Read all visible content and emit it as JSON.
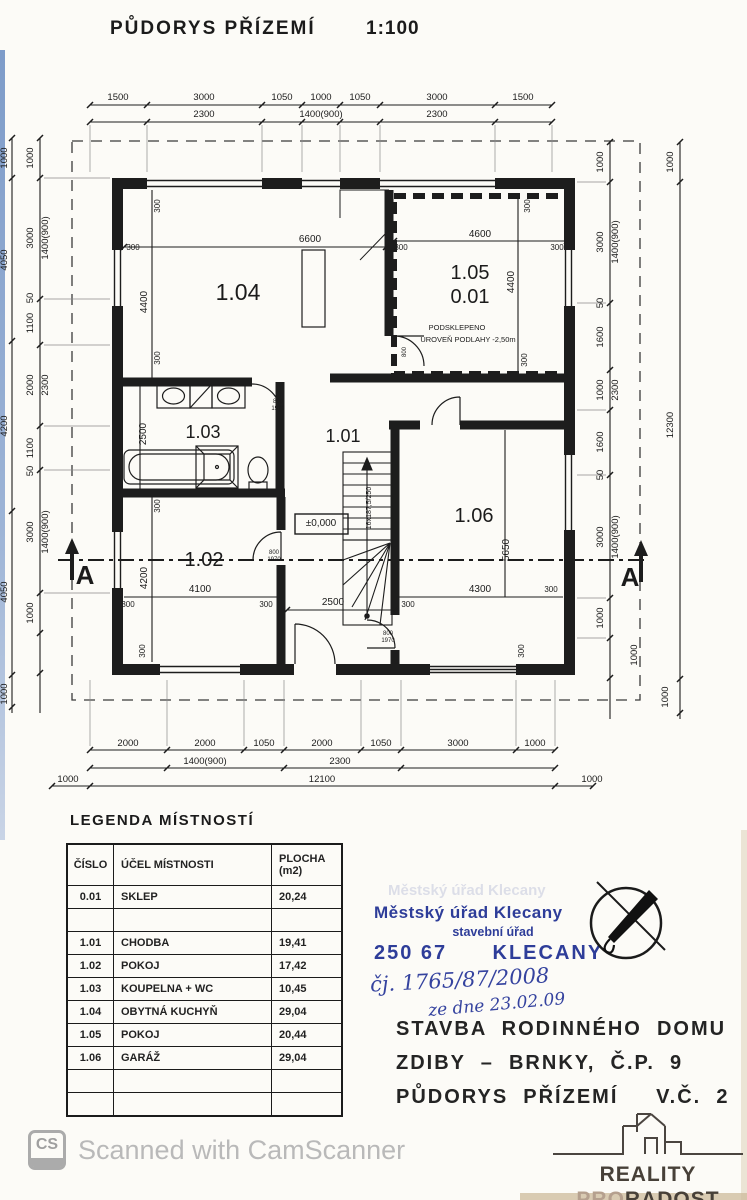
{
  "page": {
    "title": "PŮDORYS PŘÍZEMÍ",
    "scale": "1:100"
  },
  "colors": {
    "ink": "#1b1b1b",
    "stamp_blue": "#2e3d99",
    "handwriting_blue": "#35439f",
    "watermark_gray": "#b9b9b9",
    "logo_dark": "#474038",
    "logo_tan": "#b5a08e"
  },
  "legend": {
    "heading": "LEGENDA MÍSTNOSTÍ",
    "columns": {
      "no": "ČÍSLO",
      "name": "ÚČEL MÍSTNOSTI",
      "area1": "PLOCHA",
      "area2": "(m2)"
    },
    "rows": [
      {
        "no": "0.01",
        "name": "SKLEP",
        "area": "20,24"
      },
      {
        "no": "",
        "name": "",
        "area": ""
      },
      {
        "no": "1.01",
        "name": "CHODBA",
        "area": "19,41"
      },
      {
        "no": "1.02",
        "name": "POKOJ",
        "area": "17,42"
      },
      {
        "no": "1.03",
        "name": "KOUPELNA + WC",
        "area": "10,45"
      },
      {
        "no": "1.04",
        "name": "OBYTNÁ KUCHYŇ",
        "area": "29,04"
      },
      {
        "no": "1.05",
        "name": "POKOJ",
        "area": "20,44"
      },
      {
        "no": "1.06",
        "name": "GARÁŽ",
        "area": "29,04"
      },
      {
        "no": "",
        "name": "",
        "area": ""
      },
      {
        "no": "",
        "name": "",
        "area": ""
      }
    ]
  },
  "stamp": {
    "line1": "Městský úřad Klecany",
    "line2": "stavební úřad",
    "line3": "250 67      KLECANY",
    "handwriting1": "čj. 1765/87/2008",
    "handwriting2": "ze dne 23.02.09"
  },
  "project": {
    "line1": "STAVBA  RODINNÉHO  DOMU",
    "line2": "ZDIBY  –  BRNKY,  Č.P.  9",
    "line3": "PŮDORYS  PŘÍZEMÍ     V.Č.  2"
  },
  "watermark": {
    "badge": "CS",
    "text": "Scanned with CamScanner"
  },
  "logo": {
    "name1": "REALITY",
    "pro": "PRO",
    "radost": "RADOST"
  },
  "plan": {
    "labels": [
      {
        "t": "1500",
        "x": 118,
        "y": 100
      },
      {
        "t": "3000",
        "x": 204,
        "y": 100
      },
      {
        "t": "1050",
        "x": 282,
        "y": 100
      },
      {
        "t": "1000",
        "x": 321,
        "y": 100
      },
      {
        "t": "1050",
        "x": 360,
        "y": 100
      },
      {
        "t": "3000",
        "x": 437,
        "y": 100
      },
      {
        "t": "1500",
        "x": 523,
        "y": 100
      },
      {
        "t": "2300",
        "x": 204,
        "y": 117
      },
      {
        "t": "1400(900)",
        "x": 321,
        "y": 117
      },
      {
        "t": "2300",
        "x": 437,
        "y": 117
      },
      {
        "t": "2000",
        "x": 128,
        "y": 746
      },
      {
        "t": "2000",
        "x": 205,
        "y": 746
      },
      {
        "t": "1050",
        "x": 264,
        "y": 746
      },
      {
        "t": "2000",
        "x": 322,
        "y": 746
      },
      {
        "t": "1050",
        "x": 381,
        "y": 746
      },
      {
        "t": "3000",
        "x": 458,
        "y": 746
      },
      {
        "t": "1000",
        "x": 535,
        "y": 746
      },
      {
        "t": "1400(900)",
        "x": 205,
        "y": 764
      },
      {
        "t": "2300",
        "x": 340,
        "y": 764
      },
      {
        "t": "1000",
        "x": 68,
        "y": 782
      },
      {
        "t": "12100",
        "x": 322,
        "y": 782
      },
      {
        "t": "1000",
        "x": 592,
        "y": 782
      },
      {
        "t": "1000",
        "x": 33,
        "y": 158,
        "r": -90
      },
      {
        "t": "3000",
        "x": 33,
        "y": 238,
        "r": -90
      },
      {
        "t": "50",
        "x": 33,
        "y": 298,
        "r": -90
      },
      {
        "t": "1100",
        "x": 33,
        "y": 323,
        "r": -90
      },
      {
        "t": "2000",
        "x": 33,
        "y": 385,
        "r": -90
      },
      {
        "t": "1100",
        "x": 33,
        "y": 448,
        "r": -90
      },
      {
        "t": "50",
        "x": 33,
        "y": 471,
        "r": -90
      },
      {
        "t": "3000",
        "x": 33,
        "y": 532,
        "r": -90
      },
      {
        "t": "1000",
        "x": 33,
        "y": 613,
        "r": -90
      },
      {
        "t": "1400(900)",
        "x": 48,
        "y": 238,
        "r": -90
      },
      {
        "t": "2300",
        "x": 48,
        "y": 385,
        "r": -90
      },
      {
        "t": "1400(900)",
        "x": 48,
        "y": 532,
        "r": -90
      },
      {
        "t": "1000",
        "x": 7,
        "y": 158,
        "r": -90
      },
      {
        "t": "4050",
        "x": 7,
        "y": 260,
        "r": -90
      },
      {
        "t": "4200",
        "x": 7,
        "y": 426,
        "r": -90
      },
      {
        "t": "4050",
        "x": 7,
        "y": 592,
        "r": -90
      },
      {
        "t": "1000",
        "x": 7,
        "y": 694,
        "r": -90
      },
      {
        "t": "1000",
        "x": 603,
        "y": 162,
        "r": -90
      },
      {
        "t": "3000",
        "x": 603,
        "y": 242,
        "r": -90
      },
      {
        "t": "50",
        "x": 603,
        "y": 303,
        "r": -90
      },
      {
        "t": "1600",
        "x": 603,
        "y": 337,
        "r": -90
      },
      {
        "t": "1000",
        "x": 603,
        "y": 390,
        "r": -90
      },
      {
        "t": "1600",
        "x": 603,
        "y": 442,
        "r": -90
      },
      {
        "t": "50",
        "x": 603,
        "y": 475,
        "r": -90
      },
      {
        "t": "3000",
        "x": 603,
        "y": 537,
        "r": -90
      },
      {
        "t": "1000",
        "x": 603,
        "y": 618,
        "r": -90
      },
      {
        "t": "1400(900)",
        "x": 618,
        "y": 242,
        "r": -90
      },
      {
        "t": "2300",
        "x": 618,
        "y": 390,
        "r": -90
      },
      {
        "t": "1400(900)",
        "x": 618,
        "y": 537,
        "r": -90
      },
      {
        "t": "1000",
        "x": 637,
        "y": 655,
        "r": -90
      },
      {
        "t": "1000",
        "x": 673,
        "y": 162,
        "r": -90
      },
      {
        "t": "12300",
        "x": 673,
        "y": 425,
        "r": -90
      },
      {
        "t": "1000",
        "x": 668,
        "y": 697,
        "r": -90
      },
      {
        "t": "1.04",
        "x": 238,
        "y": 300,
        "s": 23,
        "n": "room-number-label"
      },
      {
        "t": "300",
        "x": 160,
        "y": 206,
        "r": -90,
        "s": 8
      },
      {
        "t": "6600",
        "x": 310,
        "y": 242,
        "s": 10
      },
      {
        "t": "300",
        "x": 133,
        "y": 250,
        "s": 8
      },
      {
        "t": "4400",
        "x": 147,
        "y": 302,
        "r": -90,
        "s": 10
      },
      {
        "t": "300",
        "x": 160,
        "y": 358,
        "r": -90,
        "s": 8
      },
      {
        "t": "1.05",
        "x": 470,
        "y": 279,
        "s": 20,
        "n": "room-number-label"
      },
      {
        "t": "0.01",
        "x": 470,
        "y": 303,
        "s": 20,
        "n": "room-number-label"
      },
      {
        "t": "PODSKLEPENO",
        "x": 457,
        "y": 330,
        "s": 7.5
      },
      {
        "t": "ÚROVEŇ PODLAHY  -2,50m",
        "x": 468,
        "y": 342,
        "s": 7.5
      },
      {
        "t": "300",
        "x": 530,
        "y": 206,
        "r": -90,
        "s": 8
      },
      {
        "t": "4600",
        "x": 480,
        "y": 237,
        "s": 10
      },
      {
        "t": "300",
        "x": 401,
        "y": 250,
        "s": 8
      },
      {
        "t": "300",
        "x": 557,
        "y": 250,
        "s": 8
      },
      {
        "t": "4400",
        "x": 514,
        "y": 282,
        "r": -90,
        "s": 10
      },
      {
        "t": "300",
        "x": 527,
        "y": 360,
        "r": -90,
        "s": 8
      },
      {
        "t": "1.03",
        "x": 203,
        "y": 438,
        "s": 18,
        "n": "room-number-label"
      },
      {
        "t": "2500",
        "x": 146,
        "y": 434,
        "r": -90,
        "s": 10
      },
      {
        "t": "800",
        "x": 278,
        "y": 403,
        "s": 6,
        "n": "door-size-label"
      },
      {
        "t": "1970",
        "x": 278,
        "y": 410,
        "s": 6,
        "n": "door-size-label"
      },
      {
        "t": "1.01",
        "x": 343,
        "y": 442,
        "s": 18,
        "n": "room-number-label"
      },
      {
        "t": "±0,000",
        "x": 321,
        "y": 526,
        "s": 10,
        "n": "level-label"
      },
      {
        "t": "16x187,5/250",
        "x": 371,
        "y": 508,
        "r": -90,
        "s": 7,
        "n": "stair-label"
      },
      {
        "t": "800",
        "x": 406,
        "y": 352,
        "r": -90,
        "s": 6,
        "n": "door-size-label"
      },
      {
        "t": "1.02",
        "x": 204,
        "y": 566,
        "s": 20,
        "n": "room-number-label"
      },
      {
        "t": "300",
        "x": 160,
        "y": 506,
        "r": -90,
        "s": 8
      },
      {
        "t": "4200",
        "x": 147,
        "y": 578,
        "r": -90,
        "s": 10
      },
      {
        "t": "4100",
        "x": 200,
        "y": 592,
        "s": 10
      },
      {
        "t": "300",
        "x": 128,
        "y": 607,
        "s": 8
      },
      {
        "t": "300",
        "x": 266,
        "y": 607,
        "s": 8
      },
      {
        "t": "800",
        "x": 274,
        "y": 554,
        "s": 6,
        "n": "door-size-label"
      },
      {
        "t": "1970",
        "x": 274,
        "y": 561,
        "s": 6,
        "n": "door-size-label"
      },
      {
        "t": "2500",
        "x": 333,
        "y": 605,
        "s": 10
      },
      {
        "t": "300",
        "x": 145,
        "y": 651,
        "r": -90,
        "s": 8
      },
      {
        "t": "1.06",
        "x": 474,
        "y": 522,
        "s": 20,
        "n": "room-number-label"
      },
      {
        "t": "5650",
        "x": 509,
        "y": 550,
        "r": -90,
        "s": 10
      },
      {
        "t": "4300",
        "x": 480,
        "y": 592,
        "s": 10
      },
      {
        "t": "300",
        "x": 551,
        "y": 592,
        "s": 8
      },
      {
        "t": "300",
        "x": 408,
        "y": 607,
        "s": 8
      },
      {
        "t": "300",
        "x": 524,
        "y": 651,
        "r": -90,
        "s": 8
      },
      {
        "t": "800",
        "x": 388,
        "y": 635,
        "s": 6,
        "n": "door-size-label"
      },
      {
        "t": "1970",
        "x": 388,
        "y": 642,
        "s": 6,
        "n": "door-size-label"
      },
      {
        "t": "A",
        "x": 85,
        "y": 584,
        "s": 26,
        "w": "700",
        "n": "section-mark-label"
      },
      {
        "t": "A",
        "x": 630,
        "y": 586,
        "s": 26,
        "w": "700",
        "n": "section-mark-label"
      }
    ]
  }
}
